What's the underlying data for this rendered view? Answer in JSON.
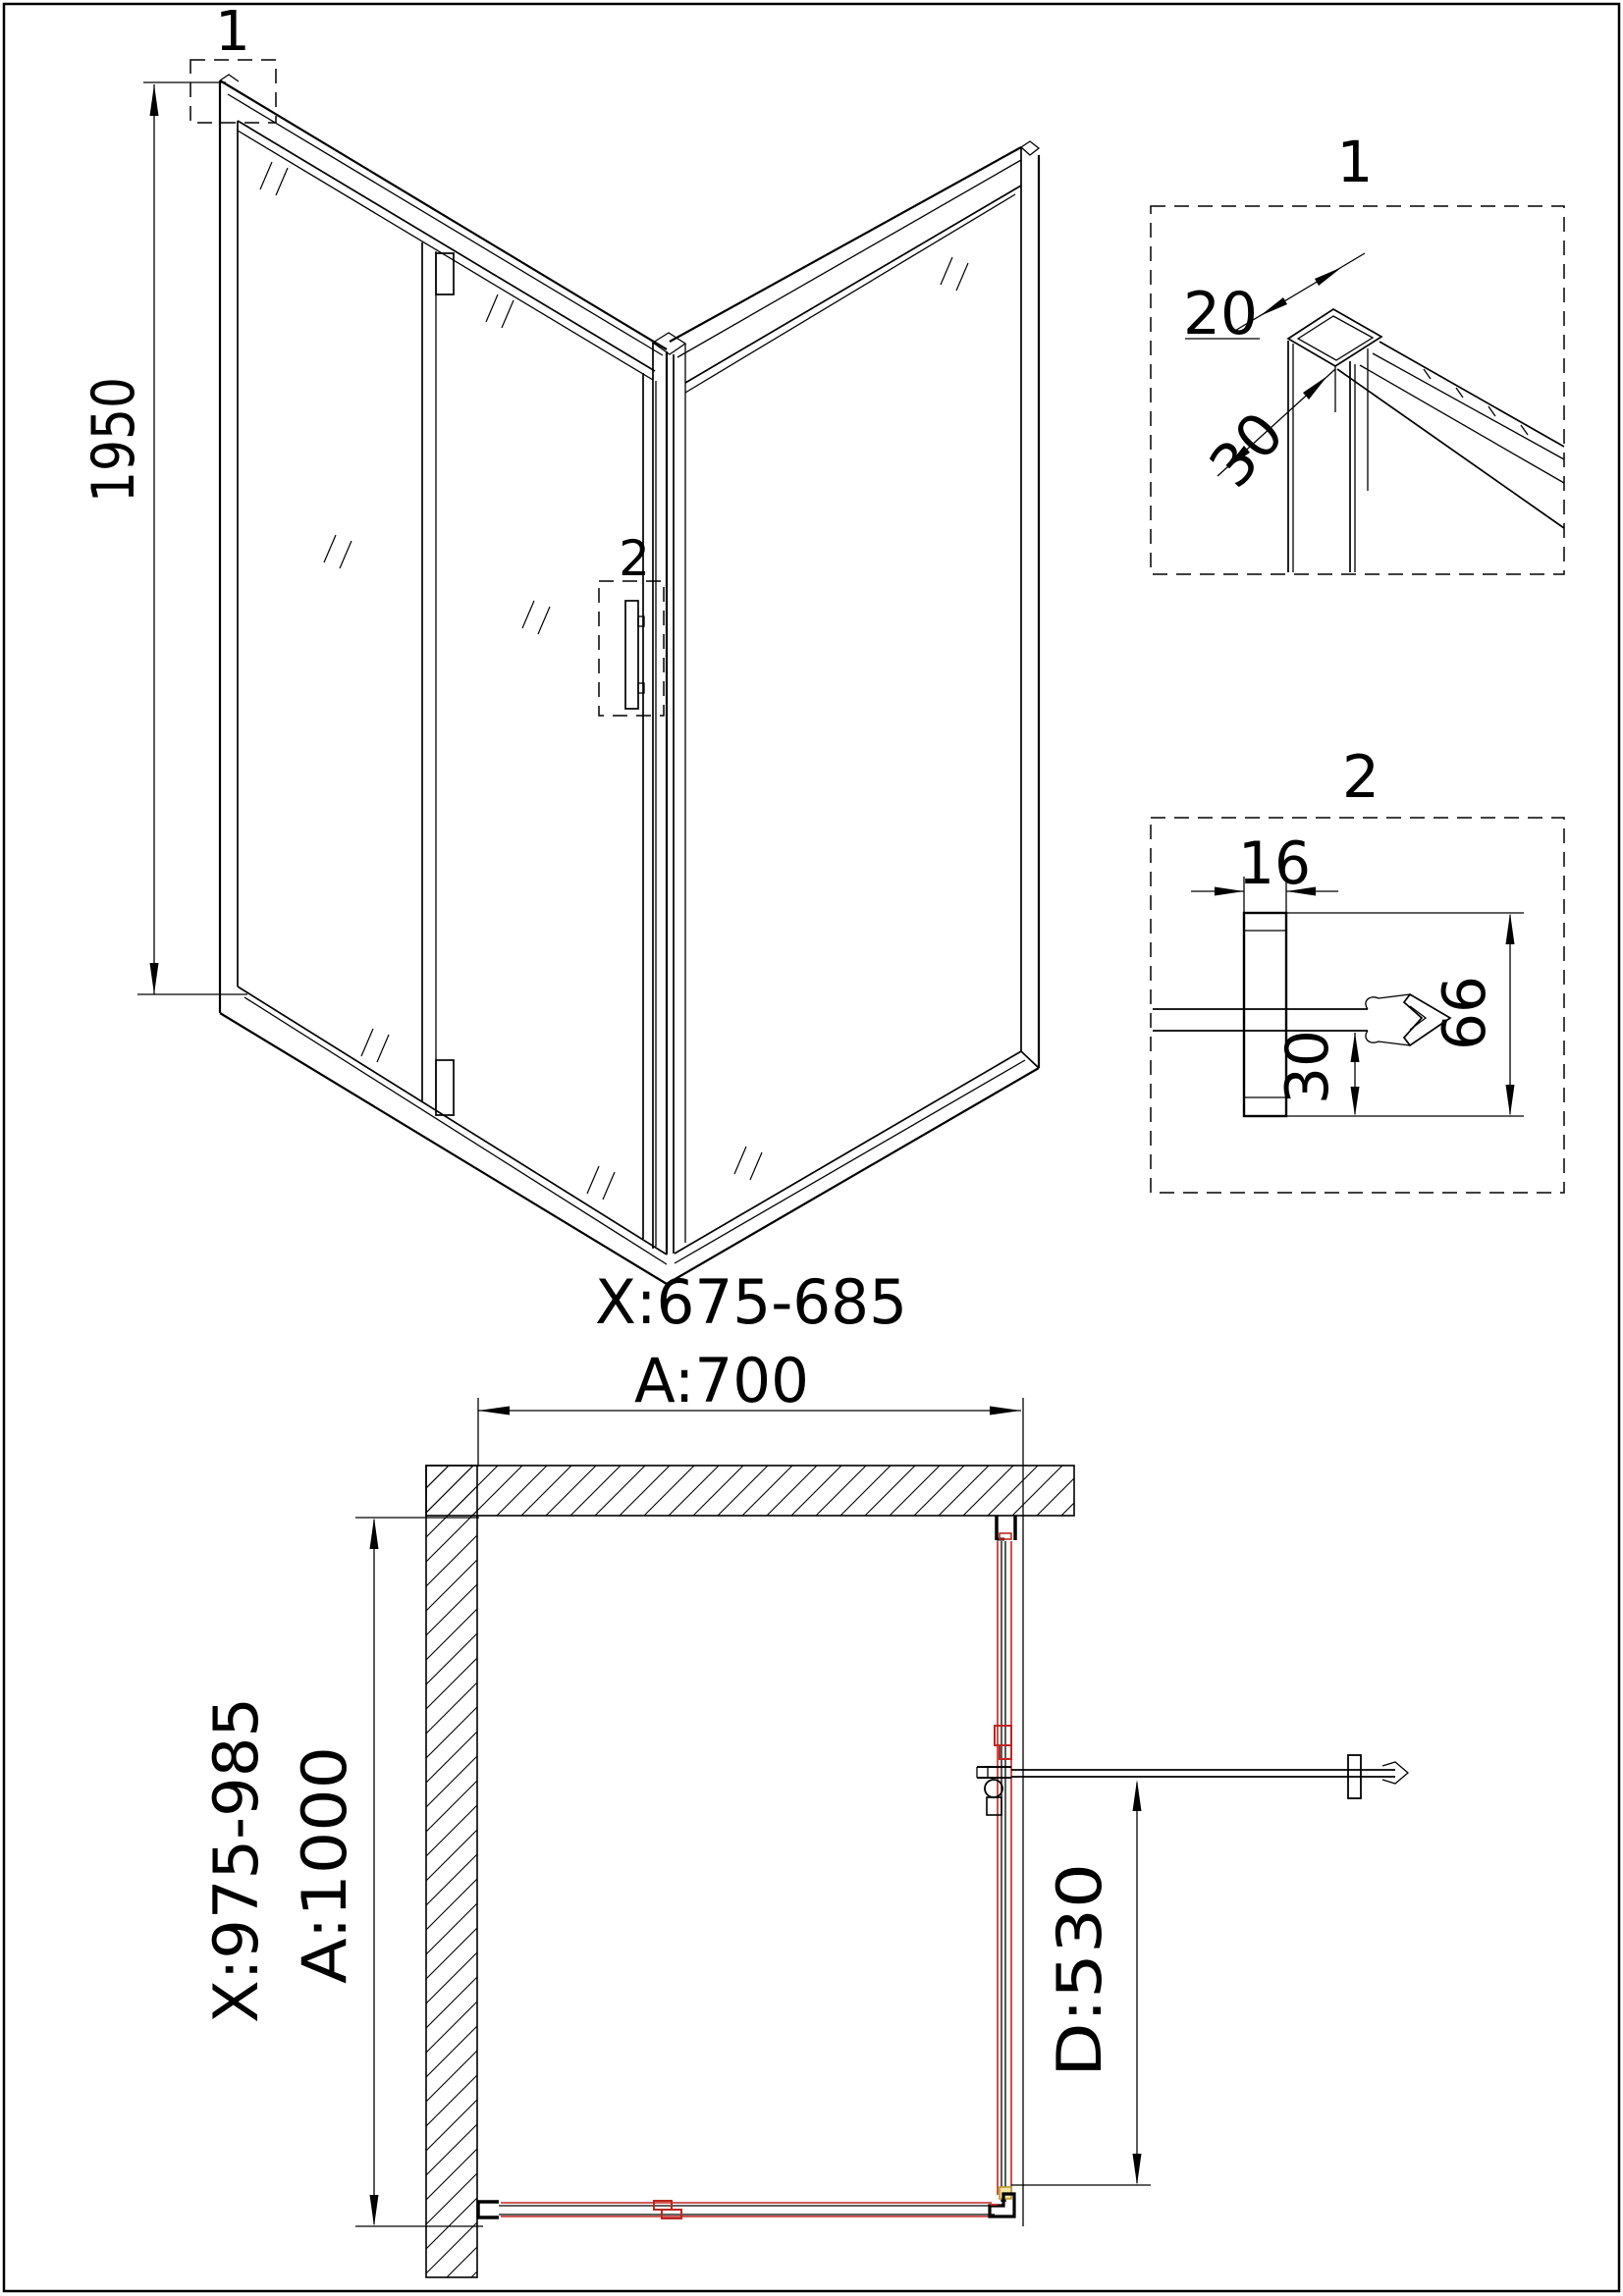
{
  "page": {
    "background": "#ffffff",
    "border_color": "#000000"
  },
  "colors": {
    "line": "#000000",
    "red_accent": "#bf2620",
    "yellow_fill": "#f5e6a8",
    "yellow_stroke": "#b89a28"
  },
  "isometric": {
    "marker_1": "1",
    "marker_2": "2",
    "dim_height": "1950",
    "dim_width_range": "X:675-685"
  },
  "detail_1": {
    "label": "1",
    "dim_profile_width": "20",
    "dim_profile_depth": "30"
  },
  "detail_2": {
    "label": "2",
    "dim_profile_width": "16",
    "dim_glass_inset": "30",
    "dim_profile_height": "66"
  },
  "plan": {
    "dim_width": "A:700",
    "dim_depth": "A:1000",
    "dim_depth_range": "X:975-985",
    "dim_door_width": "D:530"
  }
}
